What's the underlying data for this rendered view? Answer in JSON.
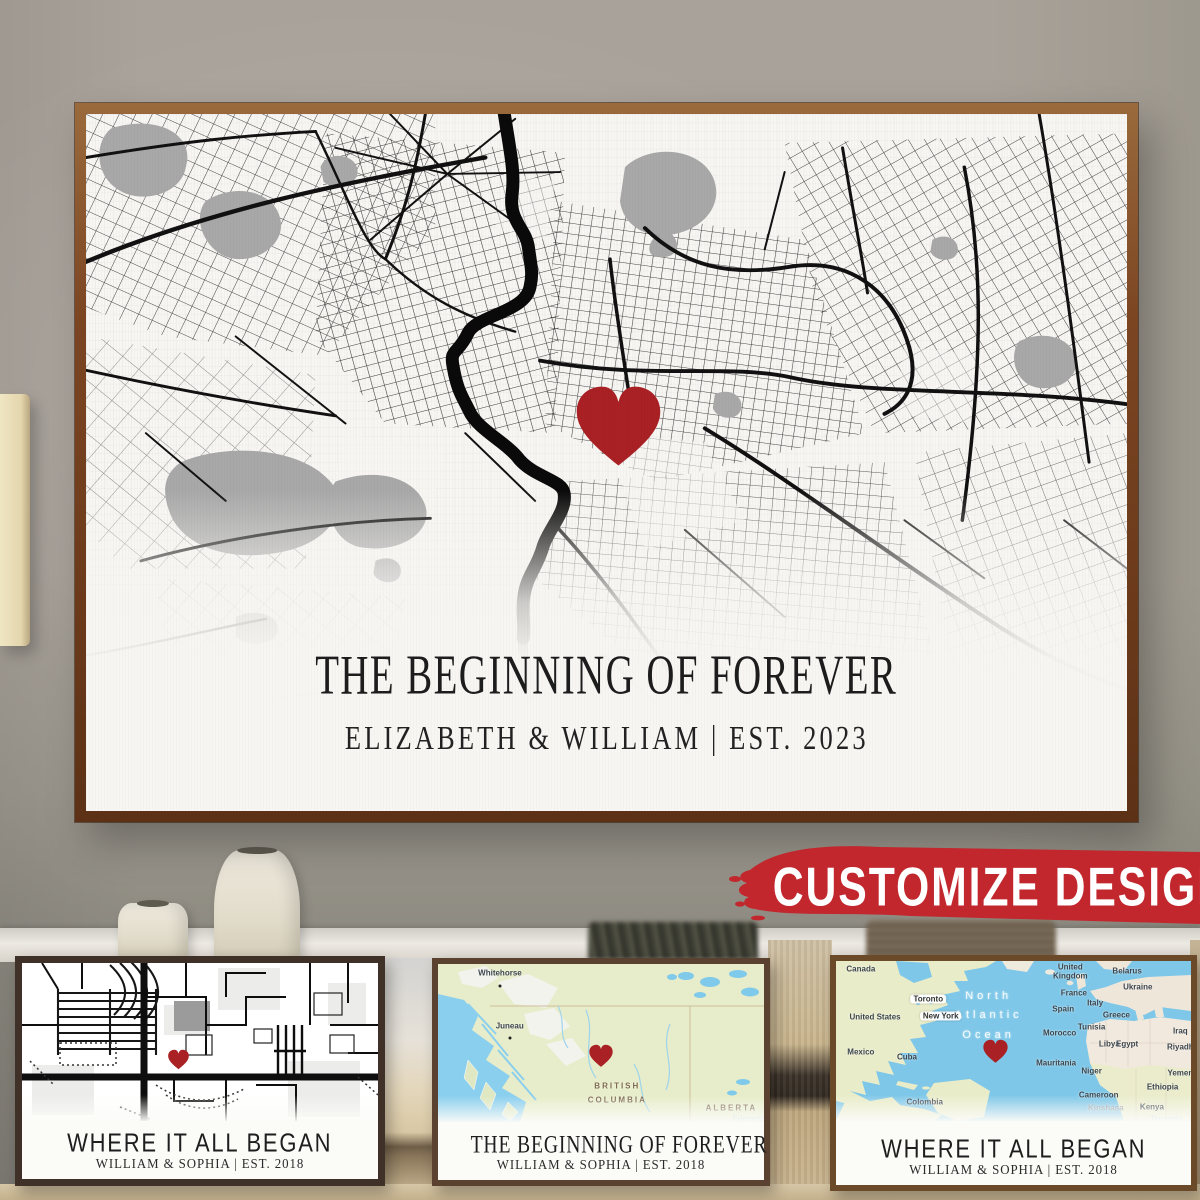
{
  "badge": {
    "label": "CUSTOMIZE DESIGN",
    "bg_color": "#c2272d",
    "text_color": "#ffffff"
  },
  "main_poster": {
    "title": "THE BEGINNING OF FOREVER",
    "subtitle": "ELIZABETH & WILLIAM  |  EST. 2023",
    "map_style": "black-and-white street map with red heart marker",
    "heart_color": "#a92124",
    "frame_color": "#7b4522"
  },
  "variants": [
    {
      "style": "bw-street-map",
      "title": "WHERE IT ALL BEGAN",
      "subtitle": "WILLIAM & SOPHIA  |  EST. 2018"
    },
    {
      "style": "color-region-map",
      "title": "THE BEGINNING OF FOREVER",
      "subtitle": "WILLIAM & SOPHIA  |  EST. 2018",
      "labels": {
        "city1": "Whitehorse",
        "city2": "Juneau",
        "region1_line1": "BRITISH",
        "region1_line2": "COLUMBIA",
        "region2": "ALBERTA",
        "faint_city": "Edmonton"
      }
    },
    {
      "style": "color-world-map",
      "title": "WHERE IT ALL BEGAN",
      "subtitle": "WILLIAM & SOPHIA  |  EST. 2018",
      "ocean": [
        "North",
        "Atlantic",
        "Ocean"
      ],
      "cities": [
        "Toronto",
        "New York"
      ],
      "places": [
        "Canada",
        "United States",
        "Mexico",
        "Cuba",
        "Colombia",
        "United Kingdom",
        "France",
        "Spain",
        "Italy",
        "Greece",
        "Belarus",
        "Ukraine",
        "Morocco",
        "Tunisia",
        "Libya",
        "Egypt",
        "Iraq",
        "Riyadh",
        "Yemen",
        "Mauritania",
        "Niger",
        "Cameroon",
        "Kinshasa",
        "Kenya",
        "Ethiopia",
        "Tanzania"
      ]
    }
  ]
}
